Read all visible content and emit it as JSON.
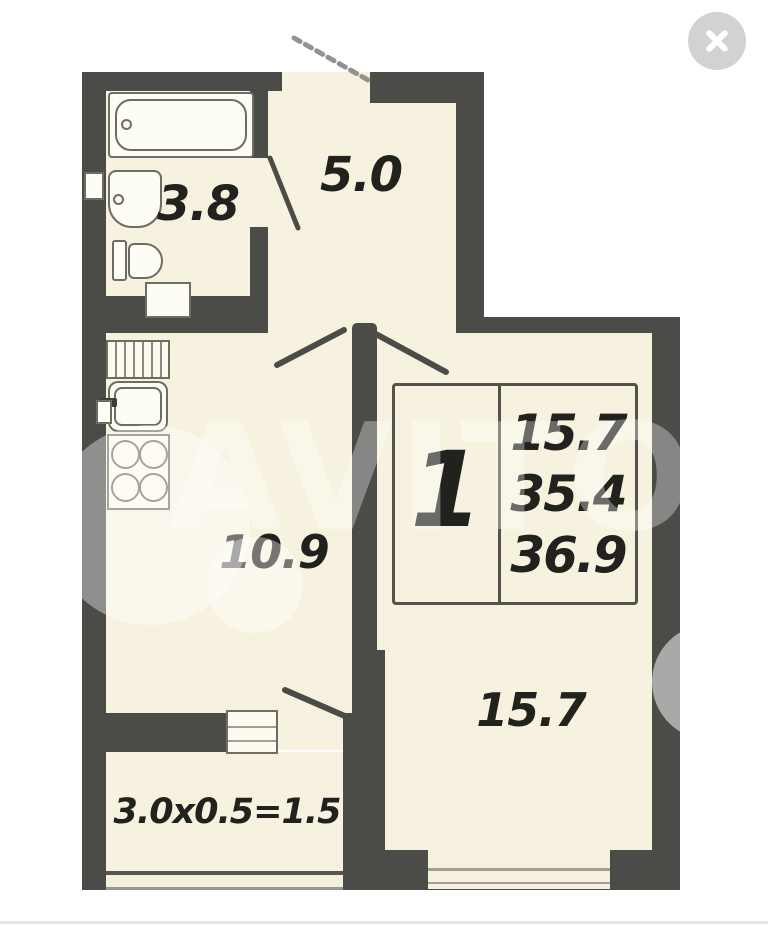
{
  "viewer": {
    "watermark_text": "AVITO",
    "close_icon": "x-mark"
  },
  "floorplan": {
    "rooms": [
      {
        "name": "bathroom",
        "area": "3.8"
      },
      {
        "name": "hallway",
        "area": "5.0"
      },
      {
        "name": "kitchen-living",
        "area": "10.9"
      },
      {
        "name": "room",
        "area": "15.7"
      }
    ],
    "balcony": {
      "formula": "3.0x0.5=1.5"
    },
    "info_box": {
      "rooms_count": "1",
      "lines": [
        "15.7",
        "35.4",
        "36.9"
      ]
    },
    "colors": {
      "wall": "#4b4b48",
      "room_fill": "#f7f2e0",
      "page_background": "#ffffff"
    }
  }
}
